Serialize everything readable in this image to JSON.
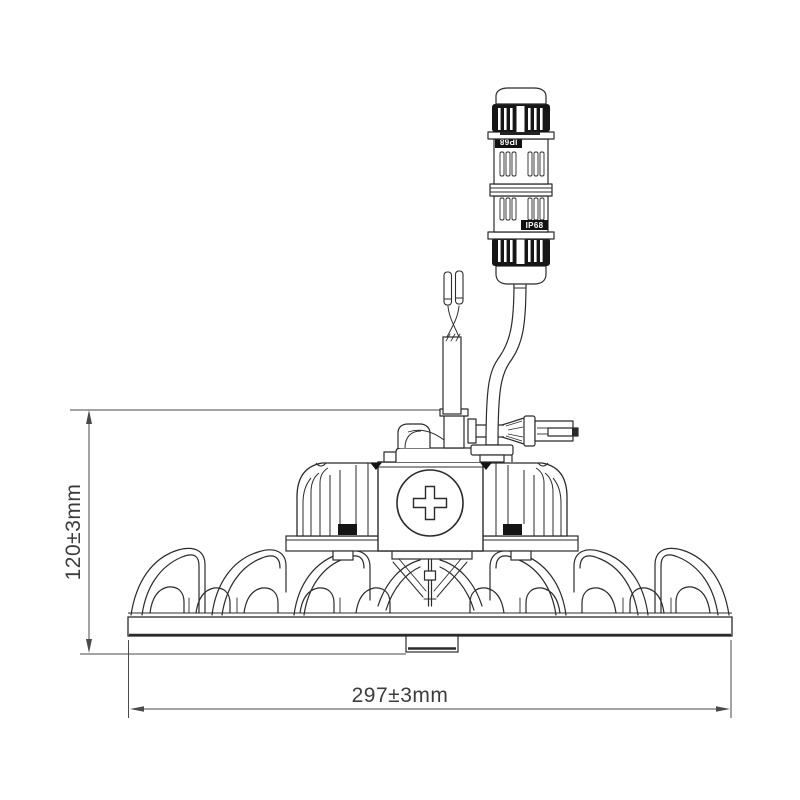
{
  "diagram": {
    "type": "technical-dimension-drawing",
    "subject": "UFO high-bay LED luminaire, side elevation with IP68 inline cable connector",
    "background_color": "#ffffff",
    "line_color": "#2b2b2b",
    "dimension_line_color": "#4a4a4a",
    "text_color": "#3d3d3d",
    "dimensions": {
      "height_label": "120±3mm",
      "width_label": "297±3mm"
    },
    "connector": {
      "rating_label_top": "IP68",
      "rating_label_bottom": "IP68"
    }
  }
}
